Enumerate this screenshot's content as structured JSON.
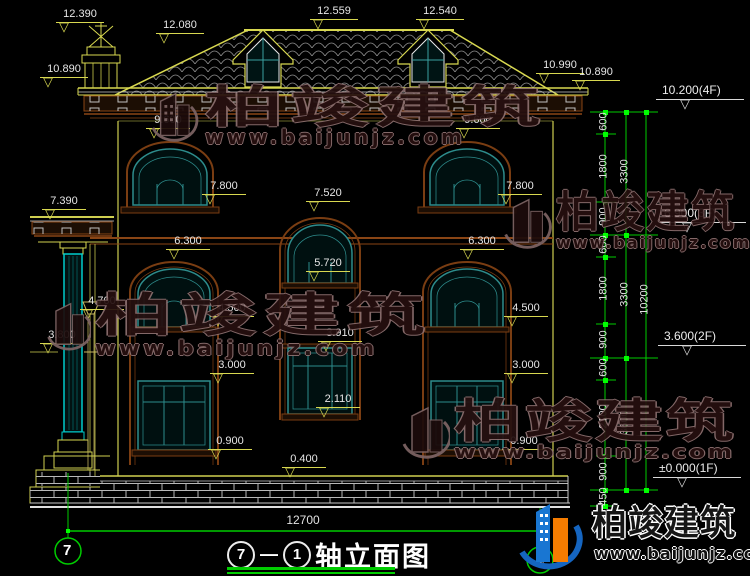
{
  "watermark": {
    "brand": "柏竣建筑",
    "url": "www.baijunjz.com"
  },
  "title": {
    "axis_from": "7",
    "axis_to": "1",
    "text": "轴立面图"
  },
  "axis": {
    "left_bubble": "7",
    "right_bubble": "1"
  },
  "overall_width": "12700",
  "marks": [
    {
      "v": "12.390"
    },
    {
      "v": "12.080"
    },
    {
      "v": "12.559"
    },
    {
      "v": "12.540"
    },
    {
      "v": "10.890"
    },
    {
      "v": "10.990"
    },
    {
      "v": "10.890"
    },
    {
      "v": "9.600"
    },
    {
      "v": "9.600"
    },
    {
      "v": "7.800"
    },
    {
      "v": "7.800"
    },
    {
      "v": "7.520"
    },
    {
      "v": "7.390"
    },
    {
      "v": "6.300"
    },
    {
      "v": "6.300"
    },
    {
      "v": "5.720"
    },
    {
      "v": "4.700"
    },
    {
      "v": "4.500"
    },
    {
      "v": "4.500"
    },
    {
      "v": "3.910"
    },
    {
      "v": "3.800"
    },
    {
      "v": "3.000"
    },
    {
      "v": "3.000"
    },
    {
      "v": "2.110"
    },
    {
      "v": "0.900"
    },
    {
      "v": "0.900"
    },
    {
      "v": "0.400"
    }
  ],
  "levels": [
    {
      "v": "10.200(4F)"
    },
    {
      "v": "6.900(3F)"
    },
    {
      "v": "3.600(2F)"
    },
    {
      "v": "±0.000(1F)"
    }
  ],
  "chain_small": [
    "600",
    "1800",
    "900",
    "600",
    "1800",
    "900",
    "600",
    "2100",
    "900",
    "450"
  ],
  "chain_mid": [
    "3300",
    "3300",
    "3600"
  ],
  "chain_total": "10200"
}
